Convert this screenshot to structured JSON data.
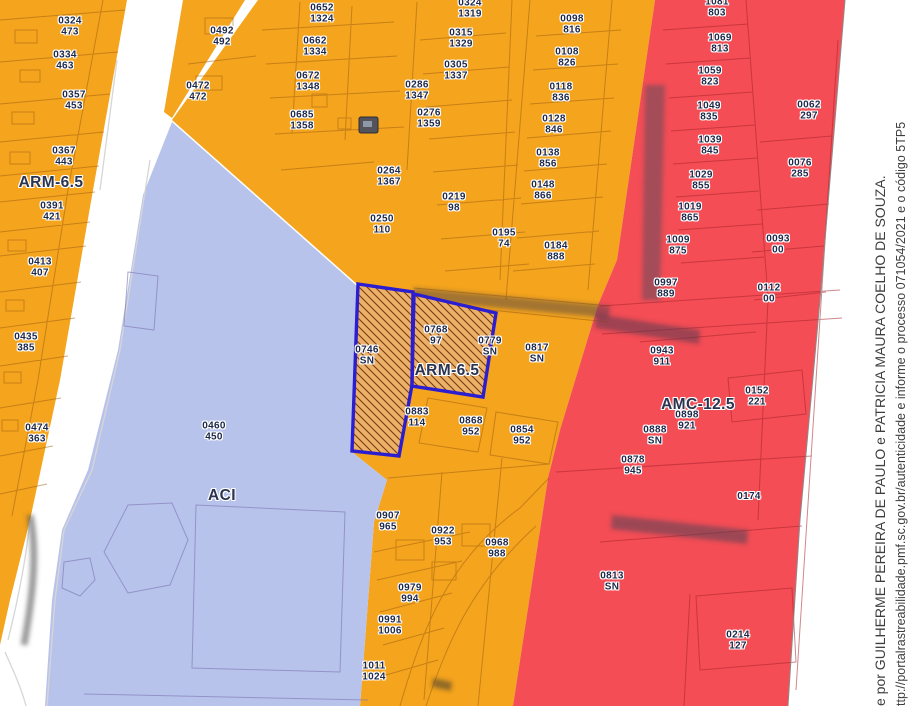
{
  "map_title": "zoning-parcel-map",
  "zone_labels": [
    {
      "text": "ARM-6.5",
      "x": 51,
      "y": 183
    },
    {
      "text": "ARM-6.5",
      "x": 447,
      "y": 371
    },
    {
      "text": "ACI",
      "x": 222,
      "y": 496
    },
    {
      "text": "AMC-12.5",
      "x": 698,
      "y": 405
    }
  ],
  "selected_parcels": [
    {
      "code": "0746",
      "sub": "SN"
    },
    {
      "code": "0768",
      "sub": "97"
    }
  ],
  "parcels": [
    {
      "code": "483",
      "sub": "",
      "x": 72,
      "y": -3
    },
    {
      "code": "0324",
      "sub": "473",
      "x": 70,
      "y": 27
    },
    {
      "code": "0334",
      "sub": "463",
      "x": 65,
      "y": 61
    },
    {
      "code": "0357",
      "sub": "453",
      "x": 74,
      "y": 101
    },
    {
      "code": "0367",
      "sub": "443",
      "x": 64,
      "y": 157
    },
    {
      "code": "0391",
      "sub": "421",
      "x": 52,
      "y": 212
    },
    {
      "code": "0413",
      "sub": "407",
      "x": 40,
      "y": 268
    },
    {
      "code": "0435",
      "sub": "385",
      "x": 26,
      "y": 343
    },
    {
      "code": "0474",
      "sub": "363",
      "x": 37,
      "y": 434
    },
    {
      "code": "0492",
      "sub": "492",
      "x": 222,
      "y": 37
    },
    {
      "code": "0472",
      "sub": "472",
      "x": 198,
      "y": 92
    },
    {
      "code": "0652",
      "sub": "1324",
      "x": 322,
      "y": 14
    },
    {
      "code": "0662",
      "sub": "1334",
      "x": 315,
      "y": 47
    },
    {
      "code": "0672",
      "sub": "1348",
      "x": 308,
      "y": 82
    },
    {
      "code": "0685",
      "sub": "1358",
      "x": 302,
      "y": 121
    },
    {
      "code": "0286",
      "sub": "1347",
      "x": 417,
      "y": 91
    },
    {
      "code": "0276",
      "sub": "1359",
      "x": 429,
      "y": 119
    },
    {
      "code": "0264",
      "sub": "1367",
      "x": 389,
      "y": 177
    },
    {
      "code": "0250",
      "sub": "110",
      "x": 382,
      "y": 225
    },
    {
      "code": "0219",
      "sub": "98",
      "x": 454,
      "y": 203
    },
    {
      "code": "0195",
      "sub": "74",
      "x": 504,
      "y": 239
    },
    {
      "code": "0184",
      "sub": "888",
      "x": 556,
      "y": 252
    },
    {
      "code": "0324",
      "sub": "1319",
      "x": 470,
      "y": 9
    },
    {
      "code": "0315",
      "sub": "1329",
      "x": 461,
      "y": 39
    },
    {
      "code": "0305",
      "sub": "1337",
      "x": 456,
      "y": 71
    },
    {
      "code": "806",
      "sub": "",
      "x": 573,
      "y": -3
    },
    {
      "code": "0098",
      "sub": "816",
      "x": 572,
      "y": 25
    },
    {
      "code": "0108",
      "sub": "826",
      "x": 567,
      "y": 58
    },
    {
      "code": "0118",
      "sub": "836",
      "x": 561,
      "y": 93
    },
    {
      "code": "0128",
      "sub": "846",
      "x": 554,
      "y": 125
    },
    {
      "code": "0138",
      "sub": "856",
      "x": 548,
      "y": 159
    },
    {
      "code": "0148",
      "sub": "866",
      "x": 543,
      "y": 191
    },
    {
      "code": "0746",
      "sub": "SN",
      "x": 367,
      "y": 356
    },
    {
      "code": "0768",
      "sub": "97",
      "x": 436,
      "y": 336
    },
    {
      "code": "0779",
      "sub": "SN",
      "x": 490,
      "y": 347
    },
    {
      "code": "0817",
      "sub": "SN",
      "x": 537,
      "y": 354
    },
    {
      "code": "0883",
      "sub": "114",
      "x": 417,
      "y": 418
    },
    {
      "code": "0868",
      "sub": "952",
      "x": 471,
      "y": 427
    },
    {
      "code": "0854",
      "sub": "952",
      "x": 522,
      "y": 436
    },
    {
      "code": "0907",
      "sub": "965",
      "x": 388,
      "y": 522
    },
    {
      "code": "0922",
      "sub": "953",
      "x": 443,
      "y": 537
    },
    {
      "code": "0968",
      "sub": "988",
      "x": 497,
      "y": 549
    },
    {
      "code": "0979",
      "sub": "994",
      "x": 410,
      "y": 594
    },
    {
      "code": "0991",
      "sub": "1006",
      "x": 390,
      "y": 626
    },
    {
      "code": "1011",
      "sub": "1024",
      "x": 374,
      "y": 672
    },
    {
      "code": "0460",
      "sub": "450",
      "x": 214,
      "y": 432
    },
    {
      "code": "1081",
      "sub": "803",
      "x": 717,
      "y": 8
    },
    {
      "code": "1069",
      "sub": "813",
      "x": 720,
      "y": 44
    },
    {
      "code": "1059",
      "sub": "823",
      "x": 710,
      "y": 77
    },
    {
      "code": "1049",
      "sub": "835",
      "x": 709,
      "y": 112
    },
    {
      "code": "1039",
      "sub": "845",
      "x": 710,
      "y": 146
    },
    {
      "code": "1029",
      "sub": "855",
      "x": 701,
      "y": 181
    },
    {
      "code": "1019",
      "sub": "865",
      "x": 690,
      "y": 213
    },
    {
      "code": "1009",
      "sub": "875",
      "x": 678,
      "y": 246
    },
    {
      "code": "0997",
      "sub": "889",
      "x": 666,
      "y": 289
    },
    {
      "code": "0062",
      "sub": "297",
      "x": 809,
      "y": 111
    },
    {
      "code": "0076",
      "sub": "285",
      "x": 800,
      "y": 169
    },
    {
      "code": "0093",
      "sub": "00",
      "x": 778,
      "y": 245
    },
    {
      "code": "0112",
      "sub": "00",
      "x": 769,
      "y": 294
    },
    {
      "code": "0943",
      "sub": "911",
      "x": 662,
      "y": 357
    },
    {
      "code": "0152",
      "sub": "221",
      "x": 757,
      "y": 397
    },
    {
      "code": "0898",
      "sub": "921",
      "x": 687,
      "y": 421
    },
    {
      "code": "0888",
      "sub": "SN",
      "x": 655,
      "y": 436
    },
    {
      "code": "0878",
      "sub": "945",
      "x": 633,
      "y": 466
    },
    {
      "code": "0174",
      "sub": "",
      "x": 749,
      "y": 497
    },
    {
      "code": "0813",
      "sub": "SN",
      "x": 612,
      "y": 582
    },
    {
      "code": "0214",
      "sub": "127",
      "x": 738,
      "y": 641
    }
  ],
  "watermark": {
    "line1": "e por GUILHERME PEREIRA DE PAULO e PATRICIA MAURA COELHO DE SOUZA.",
    "line2": "ttp://portalrastreabilidade.pmf.sc.gov.br/autenticidade e informe o processo 071054/2021 e o código 5TP5"
  },
  "colors": {
    "zone_arm": "#F4A41D",
    "zone_aci": "#B8C3EB",
    "zone_amc": "#F44D55",
    "selected_fill": "#EBB169",
    "selected_outline": "#2B1DD0",
    "hatch_line": "#7A3B10",
    "parcel_label_text": "#1D2849",
    "zone_label_text": "#2A3450",
    "watermark_text": "#3E3E3E",
    "road": "#FFFFFF"
  }
}
